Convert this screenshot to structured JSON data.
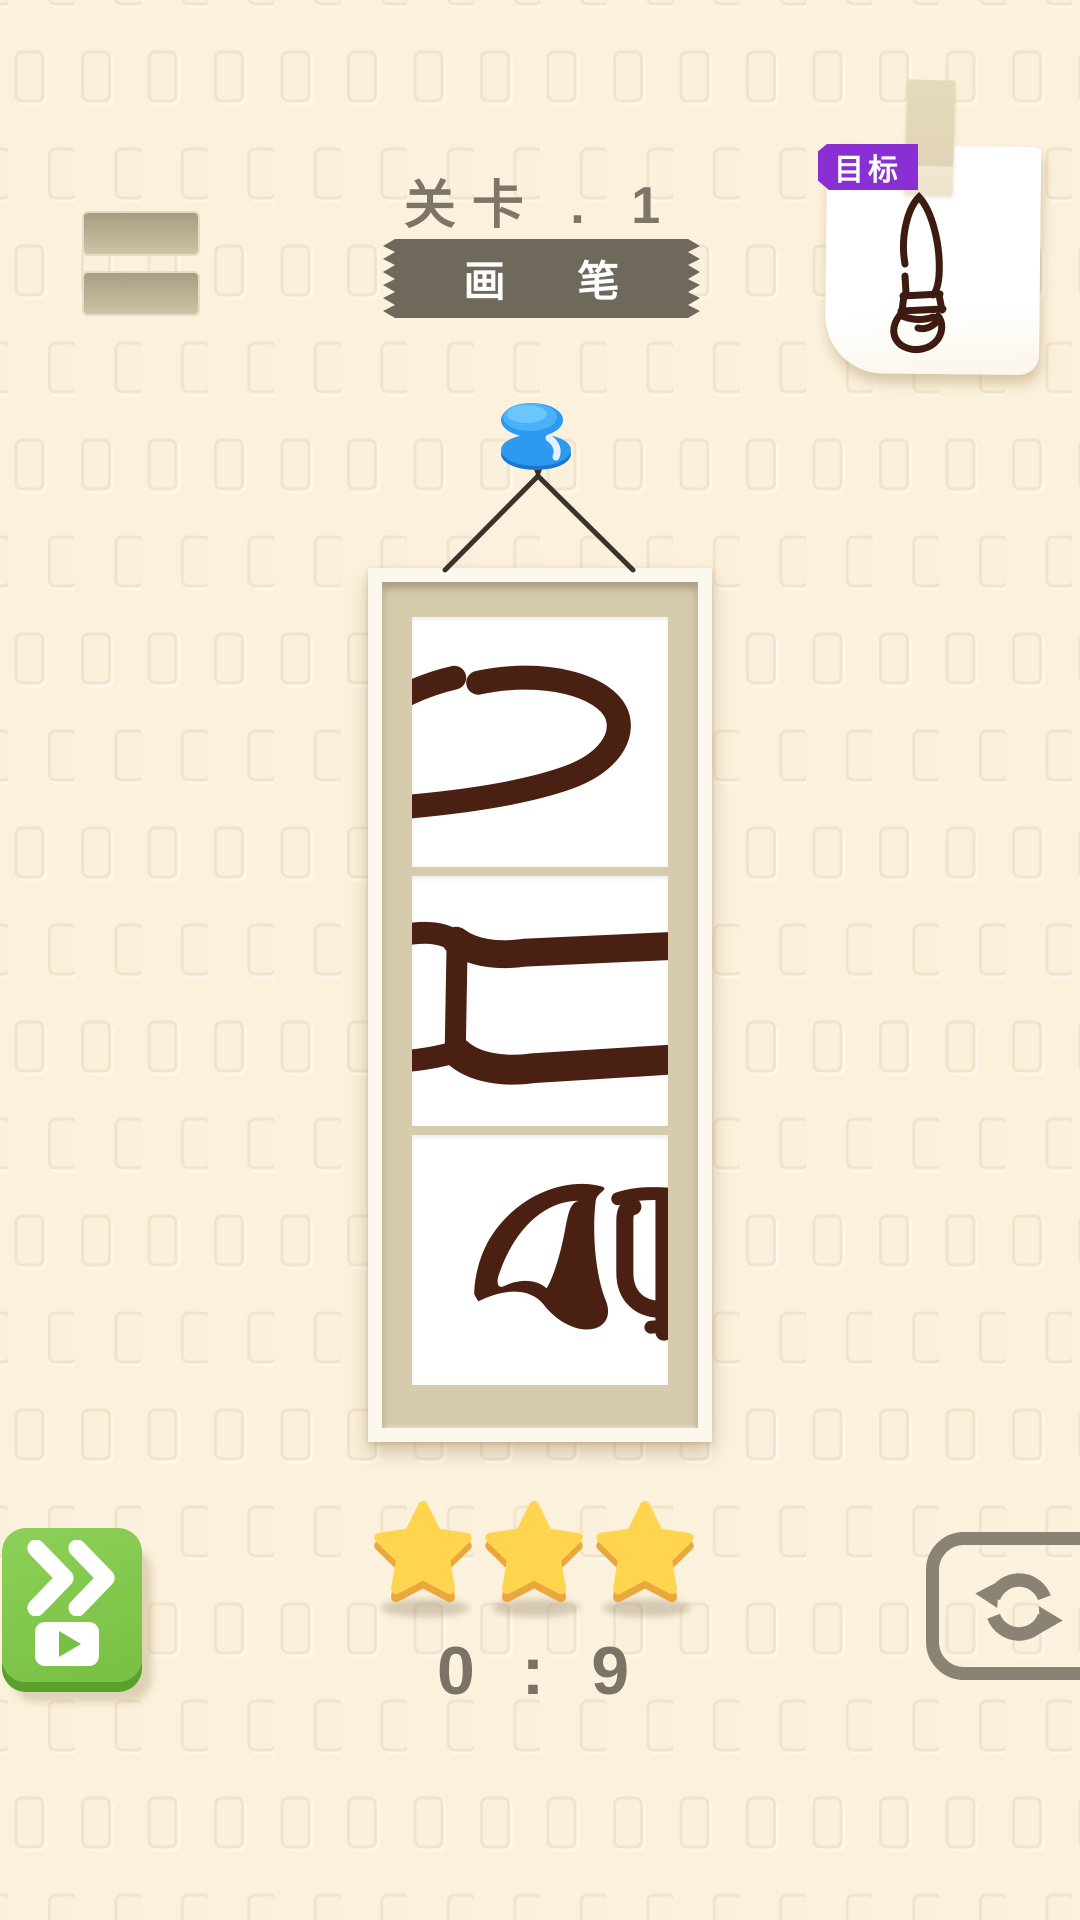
{
  "screen": {
    "width": 1080,
    "height": 1920,
    "bg_color": "#fcf1dd",
    "pattern": "embossed-rounded-rect-grid"
  },
  "header": {
    "menu_button": {
      "icon": "menu-bars-icon"
    },
    "level_label": "关卡 . 1",
    "level_label_color": "#7d7567",
    "level_name_ribbon": {
      "text": "画 笔",
      "bg_color": "#6f695c",
      "text_color": "#ffffff",
      "edge_style": "sawtooth"
    }
  },
  "target_card": {
    "badge": {
      "text": "目标",
      "bg_color": "#8a2fd3",
      "text_color": "#ffffff"
    },
    "note": {
      "icon": "paintbrush-icon",
      "paper_color": "#ffffff",
      "tape_color": "#e4d8bc",
      "ink_color": "#3d1b10"
    }
  },
  "puzzle": {
    "pin": {
      "icon": "pushpin-icon",
      "color": "#2d9af0"
    },
    "string_color": "#3a332c",
    "frame": {
      "frame_color": "#fcf8ee",
      "mat_color": "#d7cbae",
      "ink_color": "#4a2013",
      "panels": [
        {
          "name": "brush-body-segment-rotated"
        },
        {
          "name": "brush-ferrule-segment-rotated"
        },
        {
          "name": "brush-tip-segment-rotated"
        }
      ]
    }
  },
  "footer": {
    "skip_button": {
      "icons": [
        "fast-forward-icon",
        "video-play-icon"
      ],
      "bg_color": "#77c043"
    },
    "stars": {
      "count": 3,
      "fill_color": "#ffd54f",
      "bevel_color": "#e9a83d"
    },
    "timer": {
      "text": "0 : 9",
      "color": "#7b7466"
    },
    "restart_button": {
      "icon": "refresh-icon",
      "color": "#8a8272"
    }
  }
}
